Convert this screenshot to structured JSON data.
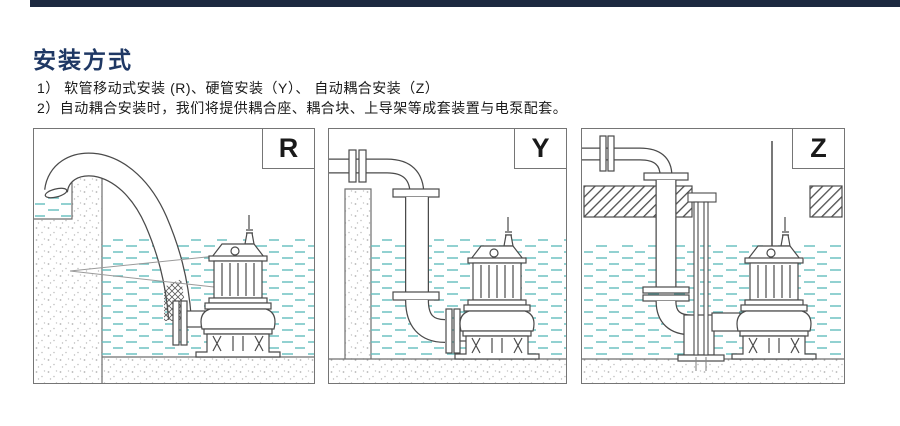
{
  "page": {
    "background": "#ffffff",
    "top_bar_color": "#1c2940"
  },
  "header": {
    "title": "安装方式",
    "title_color": "#1f3864"
  },
  "notes": [
    "1） 软管移动式安装 (R)、硬管安装（Y）、 自动耦合安装（Z）",
    "2）自动耦合安装时，我们将提供耦合座、耦合块、上导架等成套装置与电泵配套。"
  ],
  "figures": [
    {
      "label": "R"
    },
    {
      "label": "Y"
    },
    {
      "label": "Z"
    }
  ],
  "colors": {
    "diagram_line": "#4a4a4a",
    "water_dash": "#63bdbd",
    "concrete_speck": "#b9b9b9"
  }
}
